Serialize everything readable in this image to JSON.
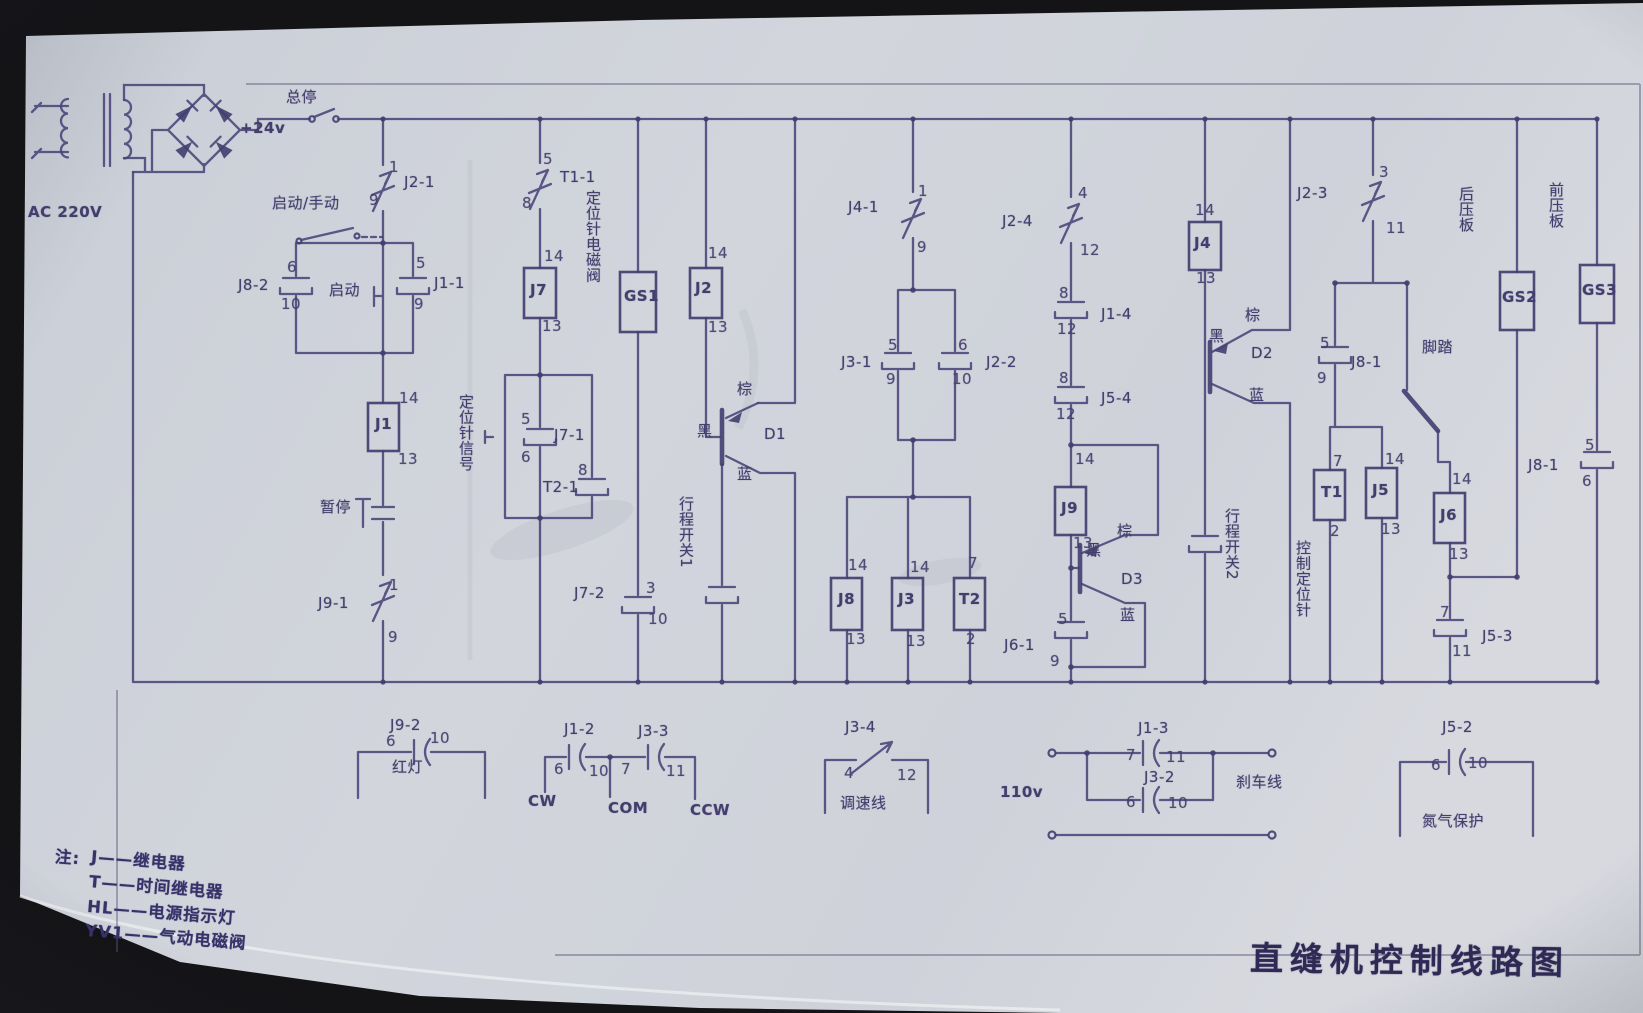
{
  "title": "直缝机控制线路图",
  "notes": {
    "prefix": "注:",
    "lines": [
      "J——继电器",
      "T——时间继电器",
      "HL——电源指示灯",
      "YV1——气动电磁阀"
    ]
  },
  "labels": [
    {
      "n": "ac-source-label",
      "t": "AC 220V",
      "x": 28,
      "y": 205,
      "c": "big"
    },
    {
      "n": "dc-24v-label",
      "t": "+24v",
      "x": 240,
      "y": 121,
      "c": "big"
    },
    {
      "n": "master-stop-label",
      "t": "总停",
      "x": 286,
      "y": 90
    },
    {
      "n": "auto-manual-label",
      "t": "启动/手动",
      "x": 272,
      "y": 196
    },
    {
      "n": "contact-j2-1-label",
      "t": "J2-1",
      "x": 404,
      "y": 175
    },
    {
      "n": "j2-1-pin-top",
      "t": "1",
      "x": 389,
      "y": 160,
      "c": "pin"
    },
    {
      "n": "j2-1-pin-bot",
      "t": "9",
      "x": 369,
      "y": 193,
      "c": "pin"
    },
    {
      "n": "contact-j8-2-label",
      "t": "J8-2",
      "x": 238,
      "y": 278
    },
    {
      "n": "j8-2-pin-top",
      "t": "6",
      "x": 287,
      "y": 260,
      "c": "pin"
    },
    {
      "n": "j8-2-pin-bot",
      "t": "10",
      "x": 281,
      "y": 297,
      "c": "pin"
    },
    {
      "n": "start-button-label",
      "t": "启动",
      "x": 329,
      "y": 283
    },
    {
      "n": "contact-j1-1-label",
      "t": "J1-1",
      "x": 434,
      "y": 276
    },
    {
      "n": "j1-1-pin-top",
      "t": "5",
      "x": 416,
      "y": 256,
      "c": "pin"
    },
    {
      "n": "j1-1-pin-bot",
      "t": "9",
      "x": 414,
      "y": 297,
      "c": "pin"
    },
    {
      "n": "j1-pin-top",
      "t": "14",
      "x": 399,
      "y": 391,
      "c": "pin"
    },
    {
      "n": "relay-j1-label",
      "t": "J1",
      "x": 375,
      "y": 417,
      "c": "box"
    },
    {
      "n": "j1-pin-bot",
      "t": "13",
      "x": 398,
      "y": 452,
      "c": "pin"
    },
    {
      "n": "pause-button-label",
      "t": "暂停",
      "x": 320,
      "y": 500
    },
    {
      "n": "contact-j9-1-label",
      "t": "J9-1",
      "x": 318,
      "y": 596
    },
    {
      "n": "j9-1-pin-top",
      "t": "1",
      "x": 389,
      "y": 578,
      "c": "pin"
    },
    {
      "n": "j9-1-pin-bot",
      "t": "9",
      "x": 388,
      "y": 630,
      "c": "pin"
    },
    {
      "n": "contact-t1-1-label",
      "t": "T1-1",
      "x": 560,
      "y": 170
    },
    {
      "n": "t1-1-pin-top",
      "t": "5",
      "x": 543,
      "y": 152,
      "c": "pin"
    },
    {
      "n": "t1-1-pin-bot",
      "t": "8",
      "x": 522,
      "y": 196,
      "c": "pin"
    },
    {
      "n": "j7-pin-top",
      "t": "14",
      "x": 544,
      "y": 249,
      "c": "pin"
    },
    {
      "n": "relay-j7-label",
      "t": "J7",
      "x": 530,
      "y": 283,
      "c": "box"
    },
    {
      "n": "j7-pin-bot",
      "t": "13",
      "x": 542,
      "y": 319,
      "c": "pin"
    },
    {
      "n": "positioning-signal-label",
      "t": "定位针信号",
      "x": 458,
      "y": 394,
      "c": "v"
    },
    {
      "n": "contact-j7-1-label",
      "t": "J7-1",
      "x": 554,
      "y": 428
    },
    {
      "n": "j7-1-pin-top",
      "t": "5",
      "x": 521,
      "y": 412,
      "c": "pin"
    },
    {
      "n": "j7-1-pin-bot",
      "t": "6",
      "x": 521,
      "y": 450,
      "c": "pin"
    },
    {
      "n": "contact-t2-1-label",
      "t": "T2-1",
      "x": 543,
      "y": 480
    },
    {
      "n": "t2-1-pin-top",
      "t": "8",
      "x": 578,
      "y": 463,
      "c": "pin"
    },
    {
      "n": "lamp-gs1-label",
      "t": "GS1",
      "x": 624,
      "y": 289,
      "c": "box"
    },
    {
      "n": "positioning-valve-label",
      "t": "定位针电磁阀",
      "x": 585,
      "y": 190,
      "c": "v"
    },
    {
      "n": "contact-j7-2-label",
      "t": "J7-2",
      "x": 574,
      "y": 586
    },
    {
      "n": "j7-2-pin-top",
      "t": "3",
      "x": 646,
      "y": 581,
      "c": "pin"
    },
    {
      "n": "j7-2-pin-bot",
      "t": "10",
      "x": 648,
      "y": 612,
      "c": "pin"
    },
    {
      "n": "j2-pin-top",
      "t": "14",
      "x": 708,
      "y": 246,
      "c": "pin"
    },
    {
      "n": "relay-j2-label",
      "t": "J2",
      "x": 695,
      "y": 281,
      "c": "box"
    },
    {
      "n": "j2-pin-bot",
      "t": "13",
      "x": 708,
      "y": 320,
      "c": "pin"
    },
    {
      "n": "d1-brown-label",
      "t": "棕",
      "x": 737,
      "y": 382
    },
    {
      "n": "d1-black-label",
      "t": "黑",
      "x": 697,
      "y": 424
    },
    {
      "n": "transistor-d1-label",
      "t": "D1",
      "x": 764,
      "y": 427
    },
    {
      "n": "d1-blue-label",
      "t": "蓝",
      "x": 737,
      "y": 467
    },
    {
      "n": "limit-switch1-label",
      "t": "行程开关1",
      "x": 678,
      "y": 496,
      "c": "v"
    },
    {
      "n": "contact-j4-1-label",
      "t": "J4-1",
      "x": 848,
      "y": 200
    },
    {
      "n": "j4-1-pin-top",
      "t": "1",
      "x": 918,
      "y": 184,
      "c": "pin"
    },
    {
      "n": "j4-1-pin-bot",
      "t": "9",
      "x": 917,
      "y": 240,
      "c": "pin"
    },
    {
      "n": "contact-j3-1-label",
      "t": "J3-1",
      "x": 841,
      "y": 355
    },
    {
      "n": "j3-1-pin-top",
      "t": "5",
      "x": 888,
      "y": 338,
      "c": "pin"
    },
    {
      "n": "j3-1-pin-bot",
      "t": "9",
      "x": 886,
      "y": 372,
      "c": "pin"
    },
    {
      "n": "contact-j2-2-label",
      "t": "J2-2",
      "x": 986,
      "y": 355
    },
    {
      "n": "j2-2-pin-top",
      "t": "6",
      "x": 958,
      "y": 338,
      "c": "pin"
    },
    {
      "n": "j2-2-pin-bot",
      "t": "10",
      "x": 952,
      "y": 372,
      "c": "pin"
    },
    {
      "n": "j8-pin-top",
      "t": "14",
      "x": 848,
      "y": 558,
      "c": "pin"
    },
    {
      "n": "relay-j8-label",
      "t": "J8",
      "x": 838,
      "y": 592,
      "c": "box"
    },
    {
      "n": "j8-pin-bot",
      "t": "13",
      "x": 846,
      "y": 632,
      "c": "pin"
    },
    {
      "n": "j3-pin-top",
      "t": "14",
      "x": 910,
      "y": 560,
      "c": "pin"
    },
    {
      "n": "relay-j3-label",
      "t": "J3",
      "x": 898,
      "y": 592,
      "c": "box"
    },
    {
      "n": "j3-pin-bot",
      "t": "13",
      "x": 906,
      "y": 634,
      "c": "pin"
    },
    {
      "n": "t2-pin-top",
      "t": "7",
      "x": 968,
      "y": 556,
      "c": "pin"
    },
    {
      "n": "relay-t2-label",
      "t": "T2",
      "x": 959,
      "y": 592,
      "c": "box"
    },
    {
      "n": "t2-pin-bot",
      "t": "2",
      "x": 966,
      "y": 632,
      "c": "pin"
    },
    {
      "n": "contact-j2-4-label",
      "t": "J2-4",
      "x": 1002,
      "y": 214
    },
    {
      "n": "j2-4-pin-top",
      "t": "4",
      "x": 1078,
      "y": 186,
      "c": "pin"
    },
    {
      "n": "j2-4-pin-bot",
      "t": "12",
      "x": 1080,
      "y": 243,
      "c": "pin"
    },
    {
      "n": "contact-j1-4-label",
      "t": "J1-4",
      "x": 1101,
      "y": 307
    },
    {
      "n": "j1-4-pin-top",
      "t": "8",
      "x": 1059,
      "y": 286,
      "c": "pin"
    },
    {
      "n": "j1-4-pin-bot",
      "t": "12",
      "x": 1057,
      "y": 322,
      "c": "pin"
    },
    {
      "n": "contact-j5-4-label",
      "t": "J5-4",
      "x": 1101,
      "y": 391
    },
    {
      "n": "j5-4-pin-top",
      "t": "8",
      "x": 1059,
      "y": 371,
      "c": "pin"
    },
    {
      "n": "j5-4-pin-bot",
      "t": "12",
      "x": 1056,
      "y": 407,
      "c": "pin"
    },
    {
      "n": "j9-pin-top",
      "t": "14",
      "x": 1075,
      "y": 452,
      "c": "pin"
    },
    {
      "n": "relay-j9-label",
      "t": "J9",
      "x": 1061,
      "y": 501,
      "c": "box"
    },
    {
      "n": "j9-pin-bot",
      "t": "13",
      "x": 1073,
      "y": 536,
      "c": "pin"
    },
    {
      "n": "d3-brown-label",
      "t": "棕",
      "x": 1117,
      "y": 524
    },
    {
      "n": "d3-black-label",
      "t": "黑",
      "x": 1086,
      "y": 543
    },
    {
      "n": "transistor-d3-label",
      "t": "D3",
      "x": 1121,
      "y": 572
    },
    {
      "n": "d3-blue-label",
      "t": "蓝",
      "x": 1120,
      "y": 608
    },
    {
      "n": "contact-j6-1-label",
      "t": "J6-1",
      "x": 1004,
      "y": 638
    },
    {
      "n": "j6-1-pin-top",
      "t": "5",
      "x": 1058,
      "y": 612,
      "c": "pin"
    },
    {
      "n": "j6-1-pin-bot",
      "t": "9",
      "x": 1050,
      "y": 654,
      "c": "pin"
    },
    {
      "n": "j4-pin-top",
      "t": "14",
      "x": 1195,
      "y": 203,
      "c": "pin"
    },
    {
      "n": "relay-j4-label",
      "t": "J4",
      "x": 1194,
      "y": 236,
      "c": "box"
    },
    {
      "n": "j4-pin-bot",
      "t": "13",
      "x": 1196,
      "y": 271,
      "c": "pin"
    },
    {
      "n": "d2-brown-label",
      "t": "棕",
      "x": 1245,
      "y": 308
    },
    {
      "n": "d2-black-label",
      "t": "黑",
      "x": 1209,
      "y": 329
    },
    {
      "n": "transistor-d2-label",
      "t": "D2",
      "x": 1251,
      "y": 346
    },
    {
      "n": "d2-blue-label",
      "t": "蓝",
      "x": 1249,
      "y": 388
    },
    {
      "n": "limit-switch2-label",
      "t": "行程开关2",
      "x": 1224,
      "y": 508,
      "c": "v"
    },
    {
      "n": "contact-j2-3-label",
      "t": "J2-3",
      "x": 1297,
      "y": 186
    },
    {
      "n": "j2-3-pin-top",
      "t": "3",
      "x": 1379,
      "y": 165,
      "c": "pin"
    },
    {
      "n": "j2-3-pin-bot",
      "t": "11",
      "x": 1386,
      "y": 221,
      "c": "pin"
    },
    {
      "n": "contact-j8-1-label",
      "t": "J8-1",
      "x": 1351,
      "y": 355
    },
    {
      "n": "j8-1-pin-top",
      "t": "5",
      "x": 1320,
      "y": 336,
      "c": "pin"
    },
    {
      "n": "j8-1-pin-bot",
      "t": "9",
      "x": 1317,
      "y": 371,
      "c": "pin"
    },
    {
      "n": "foot-pedal-label",
      "t": "脚踏",
      "x": 1422,
      "y": 340
    },
    {
      "n": "t1-pin-top",
      "t": "7",
      "x": 1333,
      "y": 454,
      "c": "pin"
    },
    {
      "n": "relay-t1-label",
      "t": "T1",
      "x": 1321,
      "y": 485,
      "c": "box"
    },
    {
      "n": "t1-pin-bot",
      "t": "2",
      "x": 1330,
      "y": 524,
      "c": "pin"
    },
    {
      "n": "j5-pin-top",
      "t": "14",
      "x": 1385,
      "y": 452,
      "c": "pin"
    },
    {
      "n": "relay-j5-label",
      "t": "J5",
      "x": 1372,
      "y": 483,
      "c": "box"
    },
    {
      "n": "j5-pin-bot",
      "t": "13",
      "x": 1381,
      "y": 522,
      "c": "pin"
    },
    {
      "n": "control-pin-label",
      "t": "控制定位针",
      "x": 1295,
      "y": 540,
      "c": "v"
    },
    {
      "n": "j6-pin-top",
      "t": "14",
      "x": 1452,
      "y": 472,
      "c": "pin"
    },
    {
      "n": "relay-j6-label",
      "t": "J6",
      "x": 1440,
      "y": 508,
      "c": "box"
    },
    {
      "n": "j6-pin-bot",
      "t": "13",
      "x": 1449,
      "y": 547,
      "c": "pin"
    },
    {
      "n": "contact-j5-3-label",
      "t": "J5-3",
      "x": 1482,
      "y": 629
    },
    {
      "n": "j5-3-pin-top",
      "t": "7",
      "x": 1440,
      "y": 605,
      "c": "pin"
    },
    {
      "n": "j5-3-pin-bot",
      "t": "11",
      "x": 1452,
      "y": 644,
      "c": "pin"
    },
    {
      "n": "rear-plate-label",
      "t": "后压板",
      "x": 1458,
      "y": 186,
      "c": "v"
    },
    {
      "n": "lamp-gs2-label",
      "t": "GS2",
      "x": 1502,
      "y": 290,
      "c": "box"
    },
    {
      "n": "front-plate-label",
      "t": "前压板",
      "x": 1548,
      "y": 182,
      "c": "v"
    },
    {
      "n": "lamp-gs3-label",
      "t": "GS3",
      "x": 1582,
      "y": 283,
      "c": "box"
    },
    {
      "n": "contact-j8-1b-label",
      "t": "J8-1",
      "x": 1528,
      "y": 458
    },
    {
      "n": "j8-1b-pin-top",
      "t": "5",
      "x": 1585,
      "y": 438,
      "c": "pin"
    },
    {
      "n": "j8-1b-pin-bot",
      "t": "6",
      "x": 1582,
      "y": 474,
      "c": "pin"
    },
    {
      "n": "contact-j9-2-label",
      "t": "J9-2",
      "x": 390,
      "y": 718
    },
    {
      "n": "j9-2-pin-left",
      "t": "6",
      "x": 386,
      "y": 734,
      "c": "pin"
    },
    {
      "n": "j9-2-pin-right",
      "t": "10",
      "x": 430,
      "y": 731,
      "c": "pin"
    },
    {
      "n": "red-lamp-label",
      "t": "红灯",
      "x": 392,
      "y": 760
    },
    {
      "n": "contact-j1-2-label",
      "t": "J1-2",
      "x": 564,
      "y": 722
    },
    {
      "n": "j1-2-pin-left",
      "t": "6",
      "x": 554,
      "y": 762,
      "c": "pin"
    },
    {
      "n": "j1-2-pin-right",
      "t": "10",
      "x": 589,
      "y": 764,
      "c": "pin"
    },
    {
      "n": "contact-j3-3-label",
      "t": "J3-3",
      "x": 638,
      "y": 724
    },
    {
      "n": "j3-3-pin-left",
      "t": "7",
      "x": 621,
      "y": 762,
      "c": "pin"
    },
    {
      "n": "j3-3-pin-right",
      "t": "11",
      "x": 666,
      "y": 764,
      "c": "pin"
    },
    {
      "n": "cw-label",
      "t": "CW",
      "x": 528,
      "y": 794,
      "c": "big"
    },
    {
      "n": "com-label",
      "t": "COM",
      "x": 608,
      "y": 801,
      "c": "big"
    },
    {
      "n": "ccw-label",
      "t": "CCW",
      "x": 690,
      "y": 803,
      "c": "big"
    },
    {
      "n": "contact-j3-4-label",
      "t": "J3-4",
      "x": 845,
      "y": 720
    },
    {
      "n": "j3-4-pin-left",
      "t": "4",
      "x": 844,
      "y": 766,
      "c": "pin"
    },
    {
      "n": "j3-4-pin-right",
      "t": "12",
      "x": 897,
      "y": 768,
      "c": "pin"
    },
    {
      "n": "speed-line-label",
      "t": "调速线",
      "x": 840,
      "y": 796
    },
    {
      "n": "v110-label",
      "t": "110v",
      "x": 1000,
      "y": 785,
      "c": "big"
    },
    {
      "n": "contact-j1-3-label",
      "t": "J1-3",
      "x": 1138,
      "y": 721
    },
    {
      "n": "j1-3-pin-left",
      "t": "7",
      "x": 1126,
      "y": 748,
      "c": "pin"
    },
    {
      "n": "j1-3-pin-right",
      "t": "11",
      "x": 1166,
      "y": 750,
      "c": "pin"
    },
    {
      "n": "contact-j3-2-label",
      "t": "J3-2",
      "x": 1144,
      "y": 770
    },
    {
      "n": "j3-2-pin-left",
      "t": "6",
      "x": 1126,
      "y": 795,
      "c": "pin"
    },
    {
      "n": "j3-2-pin-right",
      "t": "10",
      "x": 1168,
      "y": 796,
      "c": "pin"
    },
    {
      "n": "brake-line-label",
      "t": "刹车线",
      "x": 1236,
      "y": 775
    },
    {
      "n": "contact-j5-2-label",
      "t": "J5-2",
      "x": 1442,
      "y": 720
    },
    {
      "n": "j5-2-pin-left",
      "t": "6",
      "x": 1431,
      "y": 758,
      "c": "pin"
    },
    {
      "n": "j5-2-pin-right",
      "t": "10",
      "x": 1468,
      "y": 756,
      "c": "pin"
    },
    {
      "n": "nitrogen-label",
      "t": "氮气保护",
      "x": 1422,
      "y": 814
    }
  ]
}
